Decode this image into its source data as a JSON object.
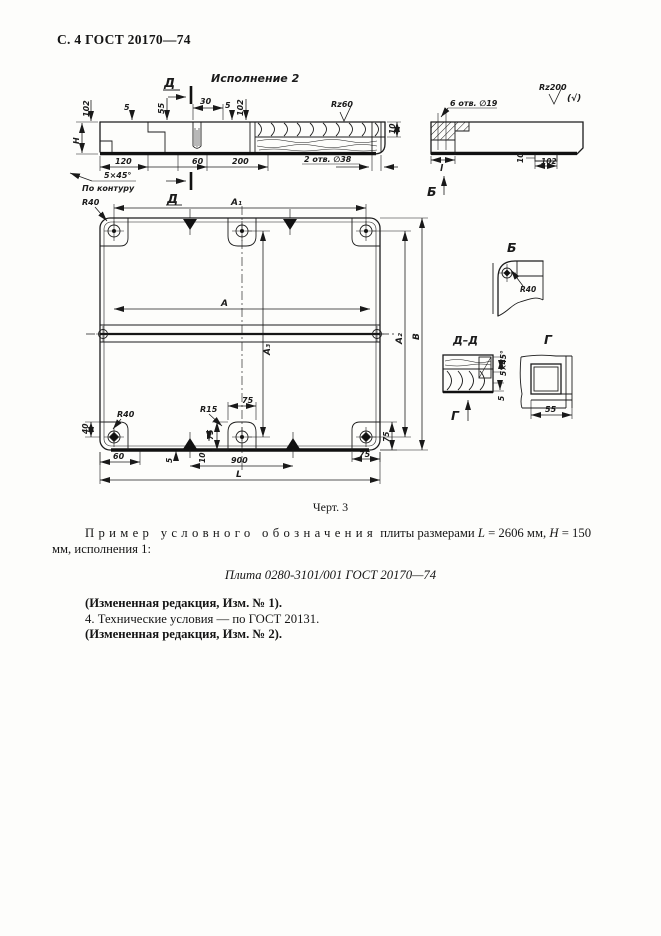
{
  "page": {
    "header": "С. 4 ГОСТ 20170—74",
    "figure_caption": "Черт. 3",
    "example": {
      "lead": "Пример условного обозначения",
      "mid": "плиты размерами",
      "var1": "L",
      "eq1": "= 2606 мм,",
      "var2": "Н",
      "eq2": "= 150 мм,",
      "tail": "исполнения 1:",
      "designation": "Плита 0280-3101/001 ГОСТ 20170—74"
    },
    "notes": {
      "amend1": "(Измененная редакция, Изм. № 1).",
      "item4": "4. Технические условия — по ГОСТ 20131.",
      "amend2": "(Измененная редакция, Изм. № 2)."
    }
  },
  "drawing": {
    "title": "Исполнение 2",
    "letters": {
      "d_top": "Д",
      "d_bottom": "Д",
      "b_arrow": "Б",
      "g_arrow": "Г",
      "detail_b": "Б",
      "section_dd": "Д–Д",
      "view_g": "Г"
    },
    "marks": {
      "rz60": "Rz60",
      "rz200": "Rz200",
      "rz200_alt": "(√)"
    },
    "dims": {
      "h102_left": "102",
      "H": "H",
      "n5_l": "5",
      "n55": "55",
      "n30": "30",
      "n5_r": "5",
      "h102_mid": "102",
      "n120": "120",
      "n60_top": "60",
      "n200": "200",
      "holes38": "2 отв. ∅38",
      "n10_wood": "10",
      "chamfer": "5×45°",
      "contour": "По контуру",
      "holes19": "6 отв. ∅19",
      "l_small": "l",
      "n10_side": "10",
      "n102_side": "102",
      "r40_tl": "R40",
      "a1": "A₁",
      "a": "A",
      "a3": "A₃",
      "a2": "A₂",
      "b": "B",
      "n40": "40",
      "r40_bl": "R40",
      "n60_bl": "60",
      "r15": "R15",
      "n75_cv": "75",
      "n75_ch": "75",
      "n5_b": "5",
      "n10_b": "10",
      "n900": "900",
      "L": "L",
      "n75_brv": "75",
      "n75_brh": "75",
      "r40_det": "R40",
      "chamfer_dd": "5×45°",
      "n5_dd": "5",
      "n55_g": "55"
    }
  }
}
